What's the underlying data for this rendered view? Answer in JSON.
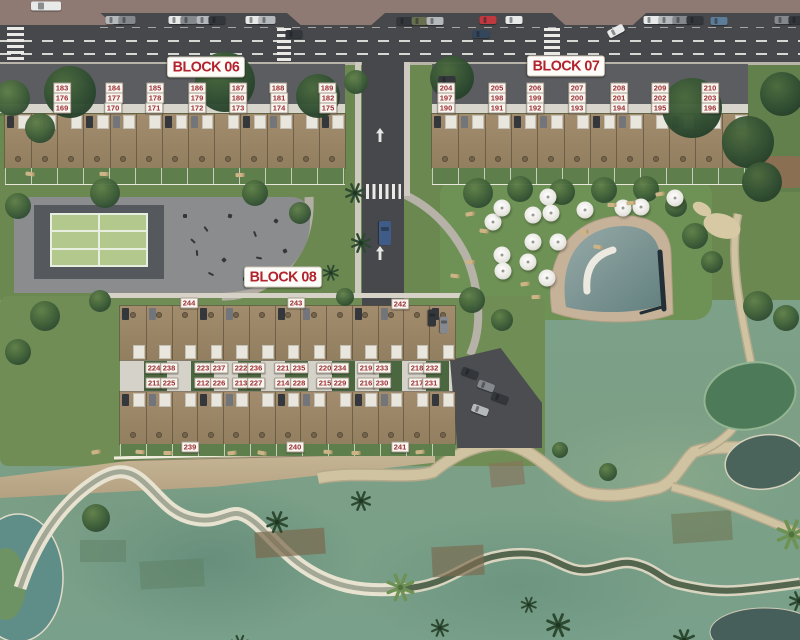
{
  "colors": {
    "label_text": "#9c2e34",
    "label_bg": "#f8f5ef",
    "title_text": "#b2232e",
    "title_bg": "#fdfcf8",
    "road": "#46484b",
    "grass": "#6b8851",
    "golf": "#7c9f86",
    "house": "#9c8769"
  },
  "block_titles": [
    {
      "id": "block-06",
      "label": "BLOCK 06",
      "x": 206,
      "y": 67
    },
    {
      "id": "block-07",
      "label": "BLOCK 07",
      "x": 566,
      "y": 66
    },
    {
      "id": "block-08",
      "label": "BLOCK 08",
      "x": 283,
      "y": 277
    }
  ],
  "unit_labels": [
    {
      "t": "183",
      "x": 62,
      "y": 88
    },
    {
      "t": "184",
      "x": 114,
      "y": 88
    },
    {
      "t": "185",
      "x": 155,
      "y": 88
    },
    {
      "t": "186",
      "x": 197,
      "y": 88
    },
    {
      "t": "187",
      "x": 238,
      "y": 88
    },
    {
      "t": "188",
      "x": 278,
      "y": 88
    },
    {
      "t": "189",
      "x": 327,
      "y": 88
    },
    {
      "t": "176",
      "x": 62,
      "y": 98
    },
    {
      "t": "177",
      "x": 114,
      "y": 98
    },
    {
      "t": "178",
      "x": 155,
      "y": 98
    },
    {
      "t": "179",
      "x": 197,
      "y": 98
    },
    {
      "t": "180",
      "x": 238,
      "y": 98
    },
    {
      "t": "181",
      "x": 279,
      "y": 98
    },
    {
      "t": "182",
      "x": 328,
      "y": 98
    },
    {
      "t": "169",
      "x": 62,
      "y": 108
    },
    {
      "t": "170",
      "x": 113,
      "y": 108
    },
    {
      "t": "171",
      "x": 154,
      "y": 108
    },
    {
      "t": "172",
      "x": 197,
      "y": 108
    },
    {
      "t": "173",
      "x": 238,
      "y": 108
    },
    {
      "t": "174",
      "x": 279,
      "y": 108
    },
    {
      "t": "175",
      "x": 328,
      "y": 108
    },
    {
      "t": "204",
      "x": 446,
      "y": 88
    },
    {
      "t": "205",
      "x": 497,
      "y": 88
    },
    {
      "t": "206",
      "x": 535,
      "y": 88
    },
    {
      "t": "207",
      "x": 577,
      "y": 88
    },
    {
      "t": "208",
      "x": 619,
      "y": 88
    },
    {
      "t": "209",
      "x": 660,
      "y": 88
    },
    {
      "t": "210",
      "x": 710,
      "y": 88
    },
    {
      "t": "197",
      "x": 446,
      "y": 98
    },
    {
      "t": "198",
      "x": 497,
      "y": 98
    },
    {
      "t": "199",
      "x": 535,
      "y": 98
    },
    {
      "t": "200",
      "x": 577,
      "y": 98
    },
    {
      "t": "201",
      "x": 619,
      "y": 98
    },
    {
      "t": "202",
      "x": 660,
      "y": 98
    },
    {
      "t": "203",
      "x": 710,
      "y": 98
    },
    {
      "t": "190",
      "x": 446,
      "y": 108
    },
    {
      "t": "191",
      "x": 497,
      "y": 108
    },
    {
      "t": "192",
      "x": 535,
      "y": 108
    },
    {
      "t": "193",
      "x": 577,
      "y": 108
    },
    {
      "t": "194",
      "x": 619,
      "y": 108
    },
    {
      "t": "195",
      "x": 660,
      "y": 108
    },
    {
      "t": "196",
      "x": 710,
      "y": 108
    },
    {
      "t": "244",
      "x": 189,
      "y": 303
    },
    {
      "t": "243",
      "x": 296,
      "y": 303
    },
    {
      "t": "242",
      "x": 400,
      "y": 304
    },
    {
      "t": "224",
      "x": 154,
      "y": 368
    },
    {
      "t": "238",
      "x": 169,
      "y": 368
    },
    {
      "t": "223",
      "x": 203,
      "y": 368
    },
    {
      "t": "237",
      "x": 219,
      "y": 368
    },
    {
      "t": "222",
      "x": 241,
      "y": 368
    },
    {
      "t": "236",
      "x": 256,
      "y": 368
    },
    {
      "t": "221",
      "x": 283,
      "y": 368
    },
    {
      "t": "235",
      "x": 299,
      "y": 368
    },
    {
      "t": "220",
      "x": 325,
      "y": 368
    },
    {
      "t": "234",
      "x": 340,
      "y": 368
    },
    {
      "t": "219",
      "x": 366,
      "y": 368
    },
    {
      "t": "233",
      "x": 382,
      "y": 368
    },
    {
      "t": "218",
      "x": 417,
      "y": 368
    },
    {
      "t": "232",
      "x": 432,
      "y": 368
    },
    {
      "t": "211",
      "x": 154,
      "y": 383
    },
    {
      "t": "225",
      "x": 169,
      "y": 383
    },
    {
      "t": "212",
      "x": 203,
      "y": 383
    },
    {
      "t": "226",
      "x": 219,
      "y": 383
    },
    {
      "t": "213",
      "x": 241,
      "y": 383
    },
    {
      "t": "227",
      "x": 256,
      "y": 383
    },
    {
      "t": "214",
      "x": 283,
      "y": 383
    },
    {
      "t": "228",
      "x": 299,
      "y": 383
    },
    {
      "t": "215",
      "x": 325,
      "y": 383
    },
    {
      "t": "229",
      "x": 340,
      "y": 383
    },
    {
      "t": "216",
      "x": 366,
      "y": 383
    },
    {
      "t": "230",
      "x": 382,
      "y": 383
    },
    {
      "t": "217",
      "x": 417,
      "y": 383
    },
    {
      "t": "231",
      "x": 431,
      "y": 383
    },
    {
      "t": "239",
      "x": 190,
      "y": 447
    },
    {
      "t": "240",
      "x": 295,
      "y": 447
    },
    {
      "t": "241",
      "x": 400,
      "y": 447
    }
  ],
  "houses": [
    {
      "id": "block-06-housing-row",
      "x": 5,
      "y": 114,
      "w": 340,
      "h": 54,
      "units": 13,
      "face": "top"
    },
    {
      "id": "block-07-housing-row",
      "x": 432,
      "y": 114,
      "w": 316,
      "h": 54,
      "units": 12,
      "face": "top"
    },
    {
      "id": "block-08-top-row",
      "x": 120,
      "y": 306,
      "w": 335,
      "h": 54,
      "units": 13,
      "face": "bottom"
    },
    {
      "id": "block-08-bottom-row",
      "x": 120,
      "y": 392,
      "w": 335,
      "h": 52,
      "units": 13,
      "face": "top"
    }
  ],
  "gardens": [
    {
      "x": 5,
      "y": 168,
      "w": 340,
      "h": 16
    },
    {
      "x": 432,
      "y": 168,
      "w": 316,
      "h": 16
    },
    {
      "x": 120,
      "y": 444,
      "w": 335,
      "h": 12
    }
  ],
  "scene": {
    "umbrellas": [
      [
        493,
        222
      ],
      [
        502,
        208
      ],
      [
        533,
        215
      ],
      [
        548,
        197
      ],
      [
        551,
        213
      ],
      [
        585,
        210
      ],
      [
        623,
        208
      ],
      [
        641,
        207
      ],
      [
        675,
        198
      ],
      [
        533,
        242
      ],
      [
        558,
        242
      ],
      [
        502,
        255
      ],
      [
        528,
        262
      ],
      [
        503,
        271
      ],
      [
        547,
        278
      ]
    ],
    "trees": [
      [
        70,
        92,
        26
      ],
      [
        225,
        82,
        30
      ],
      [
        318,
        96,
        22
      ],
      [
        12,
        98,
        18
      ],
      [
        40,
        128,
        15
      ],
      [
        356,
        82,
        12
      ],
      [
        452,
        78,
        22
      ],
      [
        692,
        108,
        30
      ],
      [
        748,
        142,
        26
      ],
      [
        782,
        94,
        22
      ],
      [
        762,
        182,
        20
      ],
      [
        478,
        193,
        15
      ],
      [
        520,
        189,
        13
      ],
      [
        562,
        192,
        13
      ],
      [
        604,
        190,
        13
      ],
      [
        646,
        189,
        13
      ],
      [
        676,
        206,
        11
      ],
      [
        18,
        206,
        13
      ],
      [
        105,
        193,
        15
      ],
      [
        255,
        193,
        13
      ],
      [
        300,
        213,
        11
      ],
      [
        45,
        316,
        15
      ],
      [
        18,
        352,
        13
      ],
      [
        100,
        301,
        11
      ],
      [
        345,
        297,
        9
      ],
      [
        472,
        300,
        13
      ],
      [
        502,
        320,
        11
      ],
      [
        695,
        236,
        13
      ],
      [
        712,
        262,
        11
      ],
      [
        758,
        306,
        15
      ],
      [
        786,
        318,
        13
      ],
      [
        96,
        518,
        14
      ],
      [
        608,
        472,
        9
      ],
      [
        560,
        450,
        8
      ]
    ],
    "palms": [
      [
        344,
        182,
        1,
        0
      ],
      [
        350,
        232,
        1,
        0
      ],
      [
        322,
        264,
        0.8,
        0
      ],
      [
        265,
        510,
        1.1,
        0
      ],
      [
        350,
        490,
        1,
        0
      ],
      [
        385,
        572,
        1.4,
        1
      ],
      [
        545,
        612,
        1.2,
        0
      ],
      [
        672,
        628,
        1.1,
        0
      ],
      [
        775,
        518,
        1.5,
        1
      ],
      [
        788,
        590,
        1,
        0
      ],
      [
        430,
        618,
        0.9,
        0
      ],
      [
        230,
        634,
        0.9,
        0
      ],
      [
        520,
        596,
        0.8,
        0
      ]
    ],
    "loungers": [
      [
        470,
        214
      ],
      [
        484,
        231
      ],
      [
        612,
        205
      ],
      [
        631,
        203
      ],
      [
        660,
        194
      ],
      [
        455,
        276
      ],
      [
        470,
        262
      ],
      [
        536,
        297
      ],
      [
        525,
        284
      ],
      [
        30,
        174
      ],
      [
        104,
        174
      ],
      [
        240,
        175
      ],
      [
        584,
        232
      ],
      [
        598,
        247
      ],
      [
        140,
        452
      ],
      [
        168,
        453
      ],
      [
        232,
        453
      ],
      [
        262,
        453
      ],
      [
        328,
        452
      ],
      [
        356,
        453
      ],
      [
        420,
        452
      ],
      [
        96,
        452
      ]
    ],
    "equipment": [
      [
        183,
        214
      ],
      [
        203,
        228
      ],
      [
        228,
        214
      ],
      [
        252,
        233
      ],
      [
        274,
        219
      ],
      [
        194,
        252
      ],
      [
        222,
        258
      ],
      [
        256,
        257
      ],
      [
        283,
        249
      ],
      [
        208,
        273
      ],
      [
        243,
        277
      ],
      [
        190,
        240
      ],
      [
        266,
        270
      ]
    ],
    "cars": [
      {
        "x": 46,
        "y": 6,
        "c": "white",
        "len": 30,
        "wid": 9
      },
      {
        "x": 114,
        "y": 20,
        "c": "silver"
      },
      {
        "x": 127,
        "y": 20,
        "c": "gray"
      },
      {
        "x": 177,
        "y": 20,
        "c": "white"
      },
      {
        "x": 189,
        "y": 20,
        "c": "gray"
      },
      {
        "x": 205,
        "y": 20,
        "c": "silver"
      },
      {
        "x": 217,
        "y": 20,
        "c": "dark"
      },
      {
        "x": 254,
        "y": 20,
        "c": "white"
      },
      {
        "x": 267,
        "y": 20,
        "c": "silver"
      },
      {
        "x": 405,
        "y": 21,
        "c": "dark"
      },
      {
        "x": 420,
        "y": 21,
        "c": "olive"
      },
      {
        "x": 435,
        "y": 21,
        "c": "silver"
      },
      {
        "x": 488,
        "y": 20,
        "c": "red"
      },
      {
        "x": 514,
        "y": 20,
        "c": "white"
      },
      {
        "x": 652,
        "y": 20,
        "c": "white"
      },
      {
        "x": 667,
        "y": 20,
        "c": "silver"
      },
      {
        "x": 681,
        "y": 20,
        "c": "gray"
      },
      {
        "x": 695,
        "y": 20,
        "c": "dark"
      },
      {
        "x": 719,
        "y": 21,
        "c": "steel"
      },
      {
        "x": 783,
        "y": 20,
        "c": "gray"
      },
      {
        "x": 797,
        "y": 20,
        "c": "dark"
      },
      {
        "x": 294,
        "y": 34,
        "c": "dark"
      },
      {
        "x": 481,
        "y": 34,
        "c": "navy"
      },
      {
        "x": 616,
        "y": 31,
        "c": "white",
        "rot": -28
      },
      {
        "x": 385,
        "y": 233,
        "c": "blue",
        "rot": 90,
        "len": 24,
        "wid": 12
      },
      {
        "x": 447,
        "y": 80,
        "c": "dark"
      },
      {
        "x": 470,
        "y": 373,
        "c": "dark",
        "rot": 20
      },
      {
        "x": 486,
        "y": 386,
        "c": "gray",
        "rot": 20
      },
      {
        "x": 500,
        "y": 398,
        "c": "dark",
        "rot": 20
      },
      {
        "x": 480,
        "y": 410,
        "c": "silver",
        "rot": 20
      },
      {
        "x": 432,
        "y": 318,
        "c": "dark",
        "rot": 90
      },
      {
        "x": 444,
        "y": 325,
        "c": "gray",
        "rot": 90
      }
    ]
  }
}
